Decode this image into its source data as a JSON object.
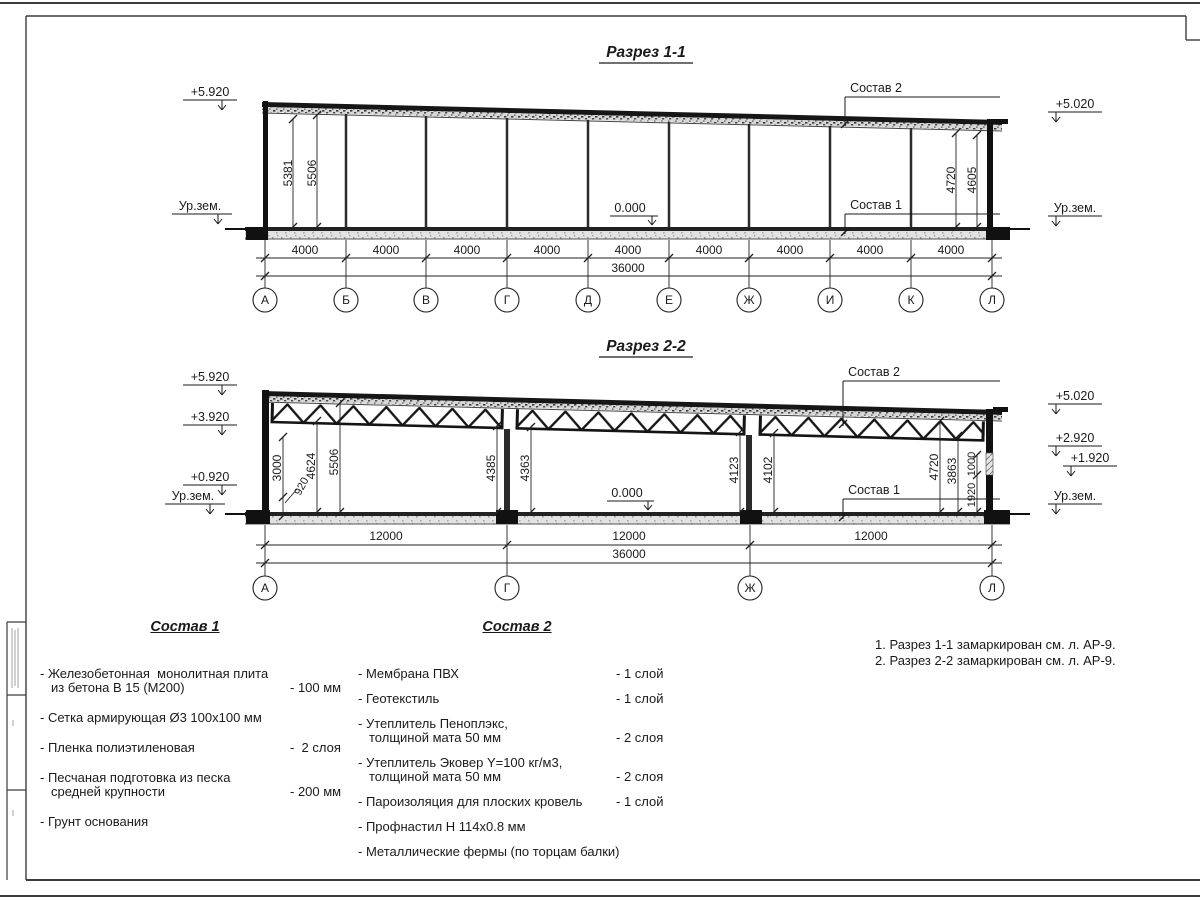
{
  "colors": {
    "line": "#1a1a1a",
    "bg": "#ffffff"
  },
  "drawing": {
    "section1": {
      "title": "Разрез 1-1",
      "elev_left_top": "+5.920",
      "ground_left": "Ур.зем.",
      "elev_right_top": "+5.020",
      "ground_right": "Ур.зем.",
      "zero": "0.000",
      "dim_5381": "5381",
      "dim_5506": "5506",
      "dim_4720": "4720",
      "dim_4605": "4605",
      "label_sostav2": "Состав 2",
      "label_sostav1": "Состав 1",
      "spans": [
        "4000",
        "4000",
        "4000",
        "4000",
        "4000",
        "4000",
        "4000",
        "4000",
        "4000"
      ],
      "total": "36000",
      "axes": [
        "А",
        "Б",
        "В",
        "Г",
        "Д",
        "Е",
        "Ж",
        "И",
        "К",
        "Л"
      ]
    },
    "section2": {
      "title": "Разрез 2-2",
      "elev_left": [
        "+5.920",
        "+3.920",
        "+0.920"
      ],
      "ground_left": "Ур.зем.",
      "elev_right": [
        "+5.020",
        "+2.920",
        "+1.920"
      ],
      "ground_right": "Ур.зем.",
      "zero": "0.000",
      "label_sostav2": "Состав 2",
      "label_sostav1": "Состав 1",
      "dims_left": [
        "3000",
        "920",
        "4624",
        "5506"
      ],
      "dims_mid": [
        "4385",
        "4363",
        "4123",
        "4102"
      ],
      "dims_right": [
        "4720",
        "3863",
        "1000",
        "1920"
      ],
      "spans": [
        "12000",
        "12000",
        "12000"
      ],
      "total": "36000",
      "axes": [
        "А",
        "Г",
        "Ж",
        "Л"
      ]
    }
  },
  "sostav1": {
    "title": "Состав 1",
    "items": [
      {
        "line1": "- Железобетонная  монолитная плита",
        "line2": "из бетона В 15 (М200)",
        "value": "- 100 мм"
      },
      {
        "line1": "- Сетка армирующая Ø3 100х100 мм",
        "line2": "",
        "value": ""
      },
      {
        "line1": "- Пленка полиэтиленовая",
        "line2": "",
        "value": "-  2 слоя"
      },
      {
        "line1": "- Песчаная подготовка из песка",
        "line2": "средней крупности",
        "value": "- 200 мм"
      },
      {
        "line1": "- Грунт основания",
        "line2": "",
        "value": ""
      }
    ]
  },
  "sostav2": {
    "title": "Состав 2",
    "items": [
      {
        "line1": "- Мембрана ПВХ",
        "line2": "",
        "value": "- 1 слой"
      },
      {
        "line1": "- Геотекстиль",
        "line2": "",
        "value": "- 1 слой"
      },
      {
        "line1": "- Утеплитель Пеноплэкс,",
        "line2": "толщиной мата 50 мм",
        "value": "- 2 слоя"
      },
      {
        "line1": "- Утеплитель Эковер Y=100 кг/м3,",
        "line2": "толщиной мата 50 мм",
        "value": "- 2 слоя"
      },
      {
        "line1": "- Пароизоляция для плоских кровель",
        "line2": "",
        "value": "- 1 слой"
      },
      {
        "line1": "- Профнастил Н 114х0.8 мм",
        "line2": "",
        "value": ""
      },
      {
        "line1": "- Металлические фермы (по торцам балки)",
        "line2": "",
        "value": ""
      }
    ]
  },
  "notes": {
    "line1": "1. Разрез 1-1 замаркирован см. л. АР-9.",
    "line2": "2. Разрез 2-2 замаркирован см. л. АР-9."
  }
}
